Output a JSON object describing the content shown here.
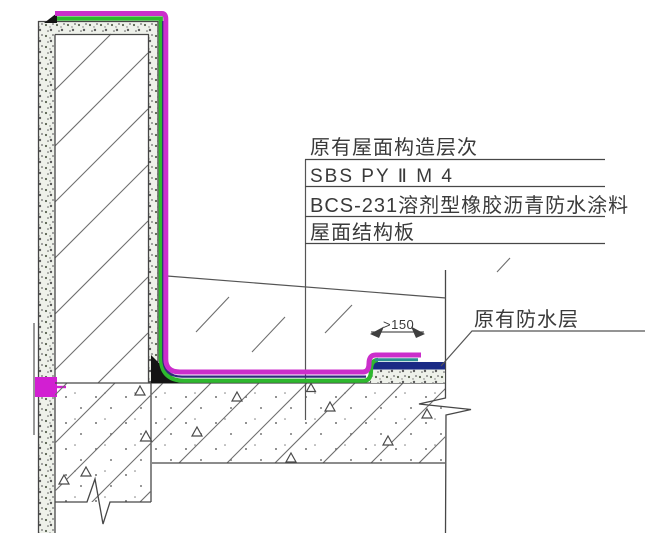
{
  "diagram": {
    "layer_callouts": [
      "原有屋面构造层次",
      "SBS PY Ⅱ M 4",
      "BCS-231溶剂型橡胶沥青防水涂料",
      "屋面结构板"
    ],
    "existing_waterproof_label": "原有防水层",
    "lap_dimension": ">150",
    "colors": {
      "sbs_membrane": "#cb2ecb",
      "bcs_coating": "#2eb82e",
      "membrane_edge": "#31287c",
      "overlap_coating": "#2d8f8f",
      "existing_waterproof": "#1a2a85",
      "wall_flashing_block": "#d21fd2",
      "sealing_cap": "#141414"
    }
  }
}
